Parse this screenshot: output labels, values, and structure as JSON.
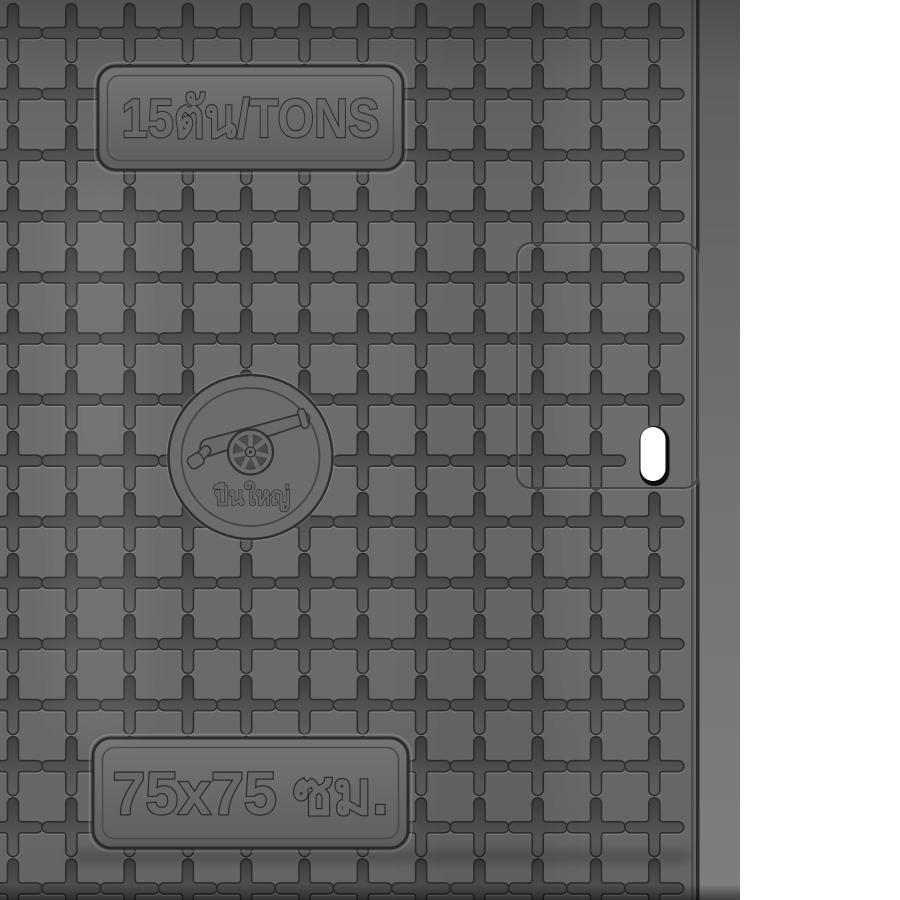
{
  "labels": {
    "load_rating": "15ตัน/TONS",
    "brand": "ปืนใหญ่",
    "size": "75x75 ซม."
  },
  "icons": {
    "logo": "cannon-icon",
    "surface_pattern": "plus-cross-relief-grid",
    "slot": "lift-slot-hole"
  },
  "colors": {
    "background": "#ffffff",
    "cover_face": "#6b6b6b",
    "cover_edge_band": "#707070",
    "groove": "#4e4e4e",
    "engraving_outline": "#2e2e2e",
    "slot_hole": "#ffffff",
    "slot_rim": "#0d0d0d"
  }
}
